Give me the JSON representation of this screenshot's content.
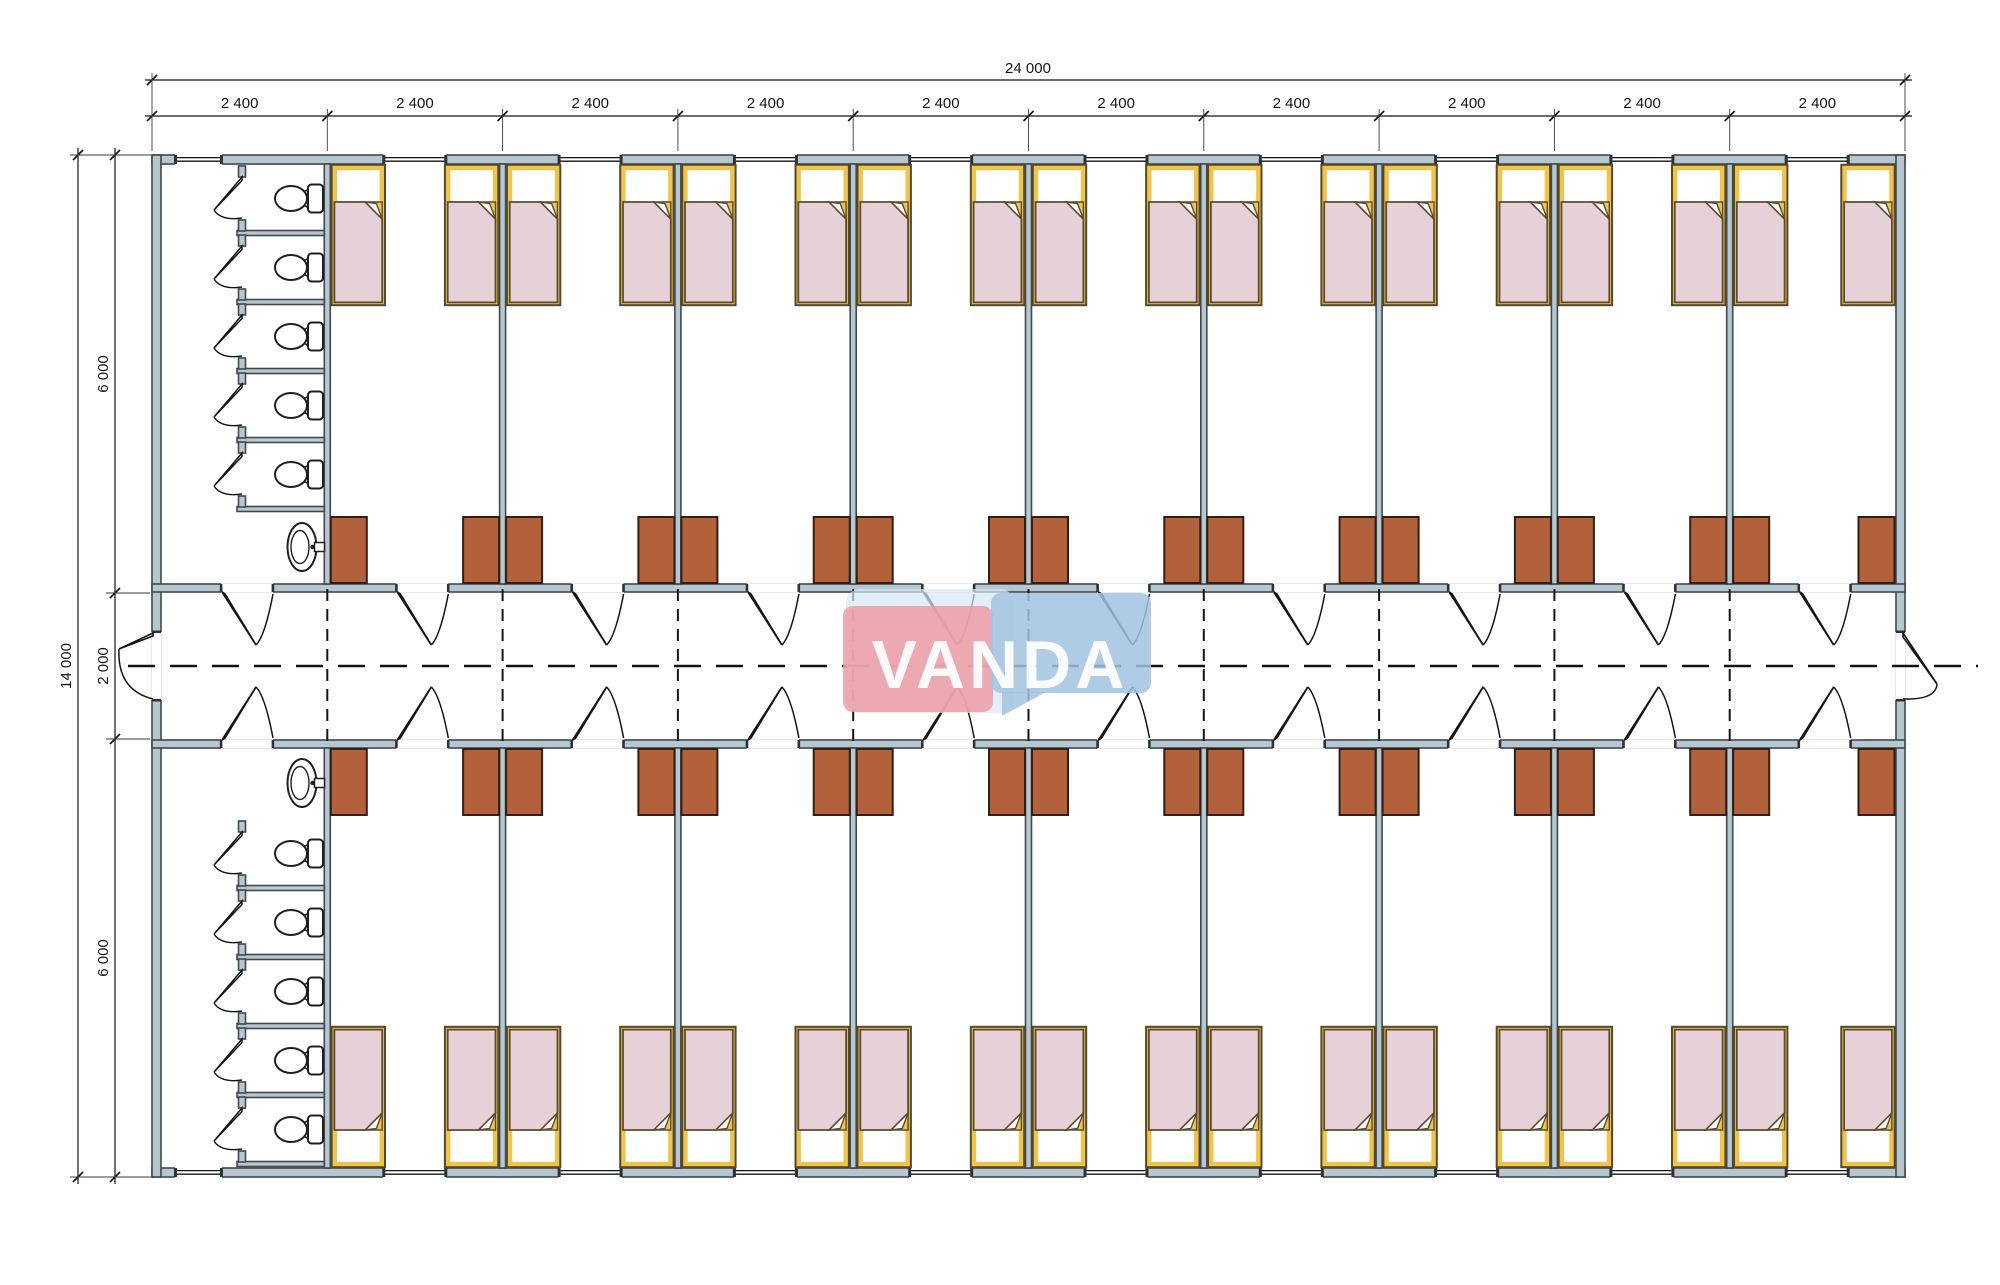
{
  "title": "Dormitory container floor plan",
  "watermark": {
    "text": "VANDA",
    "box_pink": "#ee9ca4",
    "box_blue": "#a2c3e1",
    "box_pale": "#d6e8f5",
    "text_color": "#ffffff"
  },
  "dimensions": {
    "overall_width": "24 000",
    "overall_height": "14 000",
    "bay_width": "2 400",
    "bay_count": 10,
    "left_segments": [
      "6 000",
      "2 000",
      "6 000"
    ]
  },
  "counts": {
    "bands": 2,
    "rooms_per_band": 9,
    "beds_per_room": 2,
    "cabinets_per_room": 2,
    "toilet_stalls_per_band": 5,
    "sinks_per_band": 1
  },
  "colors": {
    "background": "#ffffff",
    "wall_fill": "#b5c8d2",
    "wall_stroke": "#43484c",
    "line": "#141414",
    "extension_line": "#3a3a3a",
    "bed_frame": "#57482a",
    "bed_yellow": "#eec44d",
    "bed_blanket": "#e6d1d9",
    "bed_blanket_stroke": "#5d4b30",
    "cabinet_fill": "#b2613a",
    "cabinet_stroke": "#332015",
    "fixture_stroke": "#1f1f1f",
    "cap": "#2e3235"
  }
}
